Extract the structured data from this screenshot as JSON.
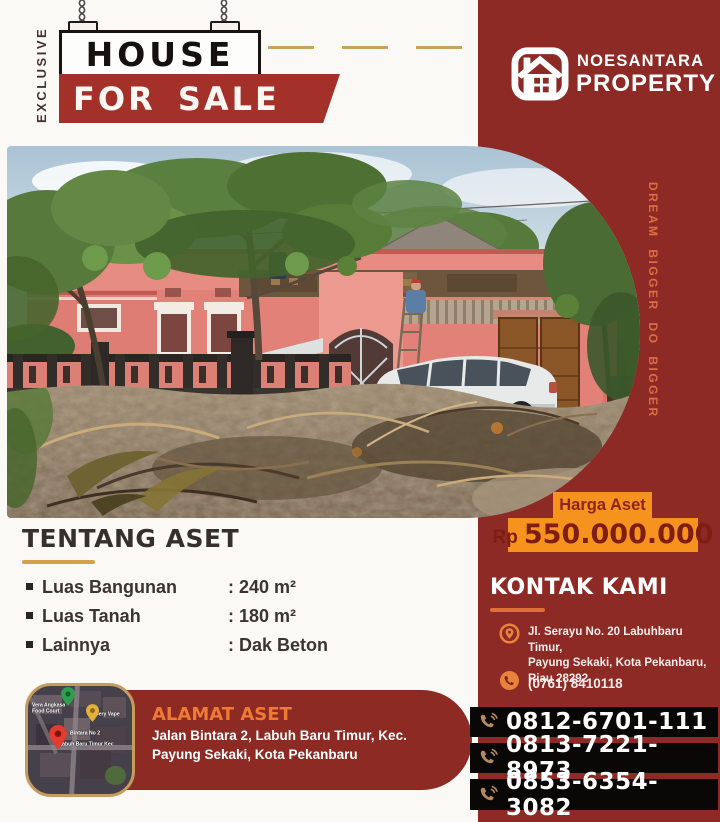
{
  "colors": {
    "maroon": "#8E2A25",
    "sale_red": "#A4302A",
    "orange_highlight": "#F6921E",
    "tagline_orange": "#DB6E44",
    "gold": "#D2A149",
    "bar_black": "#0A0707"
  },
  "sign": {
    "vertical_label": "EXCLUSIVE",
    "title": "HOUSE",
    "subtitle": "FOR SALE"
  },
  "brand": {
    "line1": "NOESANTARA",
    "line2": "PROPERTY"
  },
  "tagline": "DREAM BIGGER DO BIGGER",
  "price": {
    "label": "Harga Aset",
    "currency": "Rp",
    "amount": "550.000.000"
  },
  "about": {
    "title": "TENTANG ASET",
    "rows": [
      {
        "label": "Luas Bangunan",
        "value": ": 240 m²"
      },
      {
        "label": "Luas Tanah",
        "value": ": 180 m²"
      },
      {
        "label": "Lainnya",
        "value": ": Dak Beton"
      }
    ]
  },
  "contact": {
    "title": "KONTAK KAMI",
    "address_lines": [
      "Jl. Serayu No. 20 Labuhbaru Timur,",
      "Payung Sekaki, Kota Pekanbaru,",
      "Riau 28292"
    ],
    "office_phone": "(0761) 8410118"
  },
  "location": {
    "title": "ALAMAT ASET",
    "lines": [
      "Jalan Bintara 2, Labuh Baru Timur, Kec.",
      "Payung Sekaki, Kota Pekanbaru"
    ]
  },
  "map": {
    "labels": [
      "Vera Angkasa Food Court",
      "Dery Vape",
      "Bintara No 2",
      "Labuh Baru Timur Kec"
    ]
  },
  "hotlines": [
    {
      "number": "0812-6701-111"
    },
    {
      "number": "0813-7221-8973"
    },
    {
      "number": "0853-6354-3082"
    }
  ]
}
